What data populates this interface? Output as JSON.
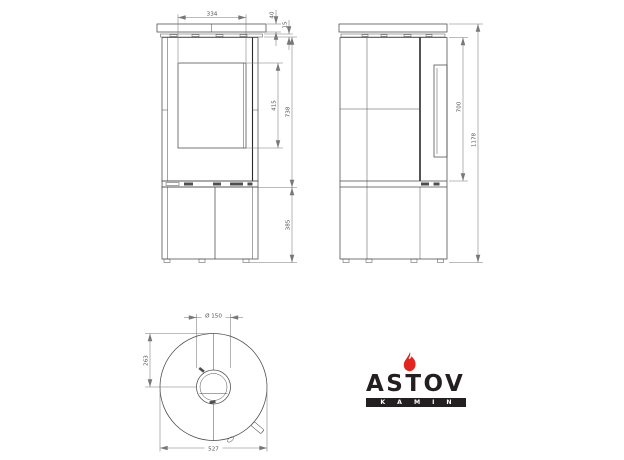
{
  "dimensions": {
    "front_view": {
      "door_glass_width": "334",
      "top_plate_thickness": "40",
      "collar_height": "15",
      "glass_height": "415",
      "upper_body_height": "738",
      "base_height": "385"
    },
    "side_view": {
      "upper_section_height": "700",
      "overall_height": "1178"
    },
    "top_view": {
      "flue_diameter": "Ø 150",
      "flue_center_offset": "263",
      "overall_diameter": "527"
    }
  },
  "logo": {
    "brand": "ASTOV",
    "tagline": "KAMIN"
  },
  "colors": {
    "line": "#4a4a4a",
    "dimension": "#787878",
    "flame_red": "#e3251f",
    "logo_dark": "#231f20"
  }
}
